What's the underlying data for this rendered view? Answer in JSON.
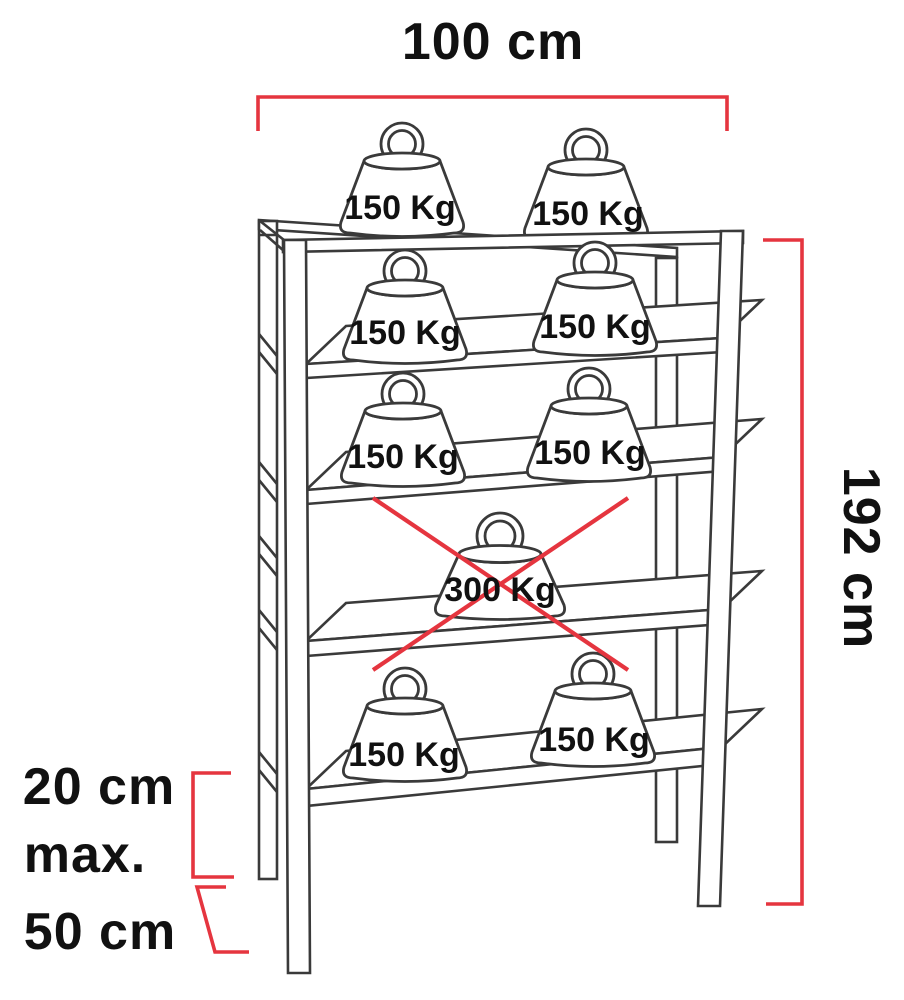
{
  "diagram": {
    "type": "shelving-unit-load-capacity-diagram",
    "dimensions": {
      "width": "100 cm",
      "height": "192 cm",
      "shelf_spacing_line1": "20 cm",
      "shelf_spacing_line2": "max.",
      "bottom_clearance": "50 cm"
    },
    "levels": [
      {
        "id": "top-shelf",
        "prohibited": false,
        "weights": [
          {
            "label": "150 Kg"
          },
          {
            "label": "150 Kg"
          }
        ]
      },
      {
        "id": "shelf-2",
        "prohibited": false,
        "weights": [
          {
            "label": "150 Kg"
          },
          {
            "label": "150 Kg"
          }
        ]
      },
      {
        "id": "shelf-3",
        "prohibited": false,
        "weights": [
          {
            "label": "150 Kg"
          },
          {
            "label": "150 Kg"
          }
        ]
      },
      {
        "id": "shelf-4",
        "prohibited": true,
        "weights": [
          {
            "label": "300 Kg"
          }
        ]
      },
      {
        "id": "bottom-shelf",
        "prohibited": false,
        "weights": [
          {
            "label": "150 Kg"
          },
          {
            "label": "150 Kg"
          }
        ]
      }
    ],
    "colors": {
      "dimension": "#e5353f",
      "line": "#3a3a3a",
      "text": "#111111"
    }
  }
}
